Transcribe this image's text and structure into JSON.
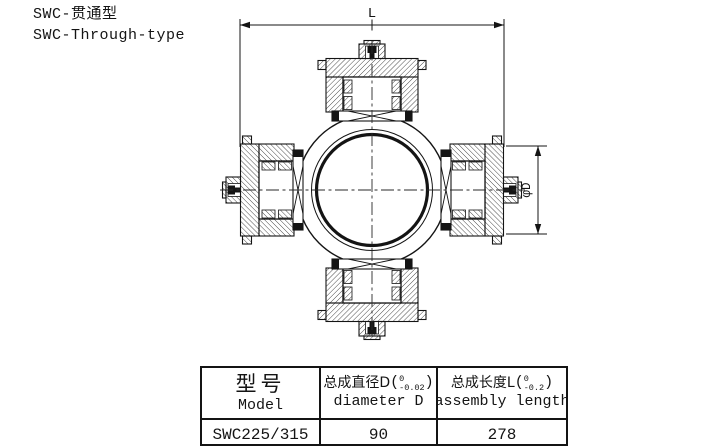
{
  "page_title": {
    "zh": "SWC-贯通型",
    "en": "SWC-Through-type"
  },
  "drawing": {
    "length_dim_label": "L",
    "diameter_dim_label": "φD"
  },
  "table": {
    "col_model": {
      "zh": "型号",
      "en": "Model"
    },
    "col_diameter": {
      "zh": "总成直径D",
      "paren_open": "(",
      "tol_upper": "0",
      "tol_lower": "-0.02",
      "paren_close": ")",
      "en": "diameter D"
    },
    "col_length": {
      "zh": "总成长度L",
      "paren_open": "(",
      "tol_upper": "0",
      "tol_lower": "-0.2",
      "paren_close": ")",
      "en": "assembly length"
    },
    "rows": [
      {
        "model": "SWC225/315",
        "diameter": "90",
        "length": "278"
      }
    ]
  }
}
